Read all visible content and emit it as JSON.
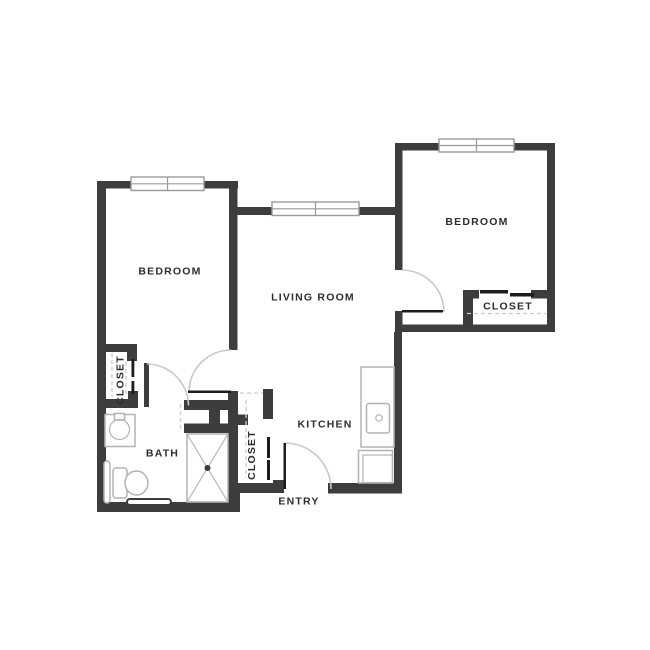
{
  "plan": {
    "canvas": {
      "width": 650,
      "height": 650
    },
    "labels": {
      "bedroom_left": "BEDROOM",
      "bedroom_right": "BEDROOM",
      "living_room": "LIVING ROOM",
      "kitchen": "KITCHEN",
      "bath": "BATH",
      "entry": "ENTRY",
      "closet_left": "CLOSET",
      "closet_middle": "CLOSET",
      "closet_right": "CLOSET"
    },
    "colors": {
      "wall": "#3d3d3d",
      "door_leaf": "#1c1c1c",
      "door_arc": "#c9c9c9",
      "dashed_line": "#cccccc",
      "window_frame": "#9a9a9a",
      "fixture_outline": "#b3b3b3",
      "label_text": "#2d2d2d",
      "background": "#ffffff"
    },
    "counts": {
      "windows": 3,
      "swing_doors": 4,
      "closets": 3
    },
    "fixtures": [
      "bath-sink",
      "toilet",
      "grab-bar",
      "towel-bar",
      "shower",
      "kitchen-counter",
      "kitchen-sink",
      "stove"
    ]
  }
}
